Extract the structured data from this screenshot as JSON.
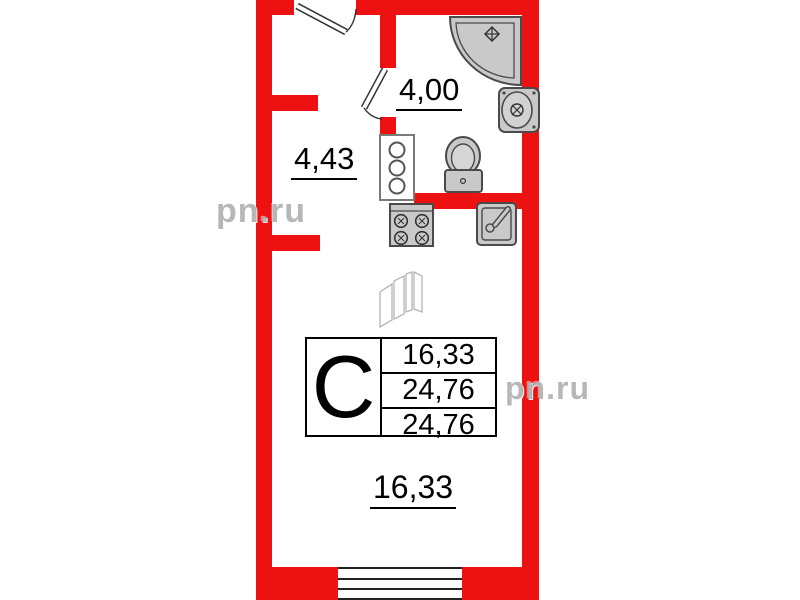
{
  "plan": {
    "labels": {
      "bathroom_area": "4,00",
      "hallway_area": "4,43",
      "room_area": "16,33"
    },
    "info_table": {
      "type_letter": "С",
      "rows": [
        "16,33",
        "24,76",
        "24,76"
      ]
    },
    "watermark_left": "pn.ru",
    "watermark_right": "pn.ru",
    "colors": {
      "wall": "#ee1111",
      "fixture_fill": "#c9c9c9",
      "fixture_stroke": "#4a4a4a"
    },
    "fixtures": [
      "corner-shower",
      "wash-basin",
      "toilet",
      "appliance-column",
      "stove",
      "kitchen-sink",
      "window",
      "entrance-door",
      "bathroom-door",
      "wardrobe-sketch"
    ]
  }
}
